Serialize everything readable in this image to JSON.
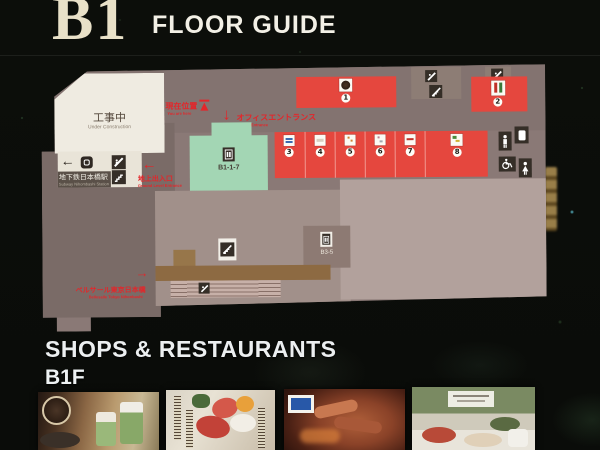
{
  "header": {
    "floor_label": "B1",
    "title": "FLOOR GUIDE"
  },
  "map": {
    "construction": {
      "ja": "工事中",
      "en": "Under Construction"
    },
    "subway_station": {
      "ja": "地下鉄日本橋駅",
      "en": "Subway Nihombashi Station"
    },
    "annotations": {
      "current_location": {
        "ja": "現在位置",
        "en": "You are here"
      },
      "office_entrance": {
        "ja": "オフィスエントランス",
        "en": "Office Entrance"
      },
      "ground_exit": {
        "ja": "地上出入口",
        "en": "Ground Level Entrance"
      },
      "bellesalle": {
        "ja": "ベルサール東京日本橋",
        "en": "Bellesalle Tokyo Nihonbashi"
      }
    },
    "arrows": {
      "left": "←",
      "right": "→",
      "down": "↓"
    },
    "labels": {
      "green_area": "B1-1-7",
      "elevator_area": "B3-5"
    },
    "shops": [
      {
        "number": "1"
      },
      {
        "number": "2"
      },
      {
        "number": "3"
      },
      {
        "number": "4"
      },
      {
        "number": "5"
      },
      {
        "number": "6"
      },
      {
        "number": "7"
      },
      {
        "number": "8"
      }
    ],
    "icons": [
      "escalator",
      "stairs",
      "elevator",
      "mens-restroom",
      "womens-restroom",
      "wheelchair",
      "coin-locker",
      "subway-logo",
      "location-marker",
      "coffee-shop-logo"
    ],
    "colors": {
      "shop_red": "#e5473e",
      "area_green": "#a3d6b4",
      "map_base": "#8a7976",
      "corridor_brown": "#8d6a42",
      "annotation_red": "#e3262a",
      "construction_white": "#efebe1"
    }
  },
  "footer": {
    "heading": "SHOPS & RESTAURANTS",
    "floor": "B1F"
  }
}
